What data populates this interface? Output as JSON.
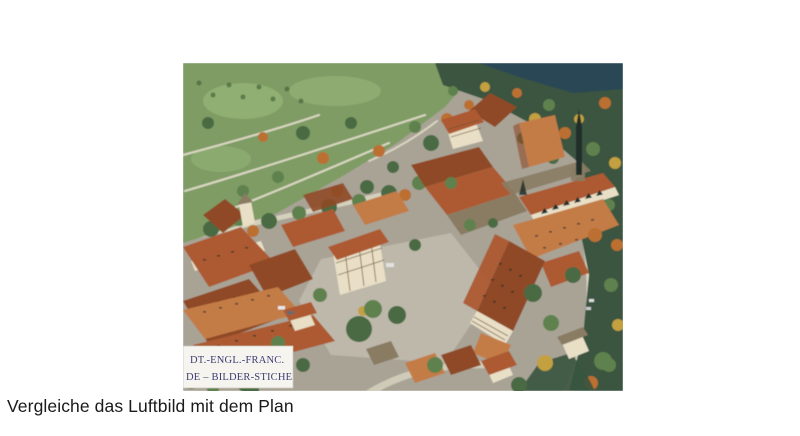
{
  "palette": {
    "page-bg": "#ffffff",
    "caption-color": "#1a1a1a",
    "photo-base": "#a9a396",
    "courtyard": "#bdb8aa",
    "grass": "#7e9c64",
    "grass-light": "#95b476",
    "path": "#d8d5c0",
    "forest-dark": "#3a5540",
    "lake": "#2c4656",
    "tree-green": "#4a6a42",
    "tree-mid": "#5f814d",
    "tree-autumn": "#bb7030",
    "tree-yellow": "#c3a040",
    "roof-red": "#ad5a30",
    "roof-deep": "#8f4a26",
    "roof-bright": "#c47c46",
    "roof-gray": "#8a7c64",
    "wall-cream": "#e8dfc6",
    "timber": "#6b5136",
    "spire-dark": "#222f2a",
    "label-bg": "#f6f4ee",
    "label-text": "#3d3d74"
  },
  "caption": {
    "text": "Vergleiche das Luftbild mit dem Plan"
  },
  "photo": {
    "label_line1": "DT.-ENGL.-FRANC.",
    "label_line2": "DE – BILDER-STICHE"
  }
}
